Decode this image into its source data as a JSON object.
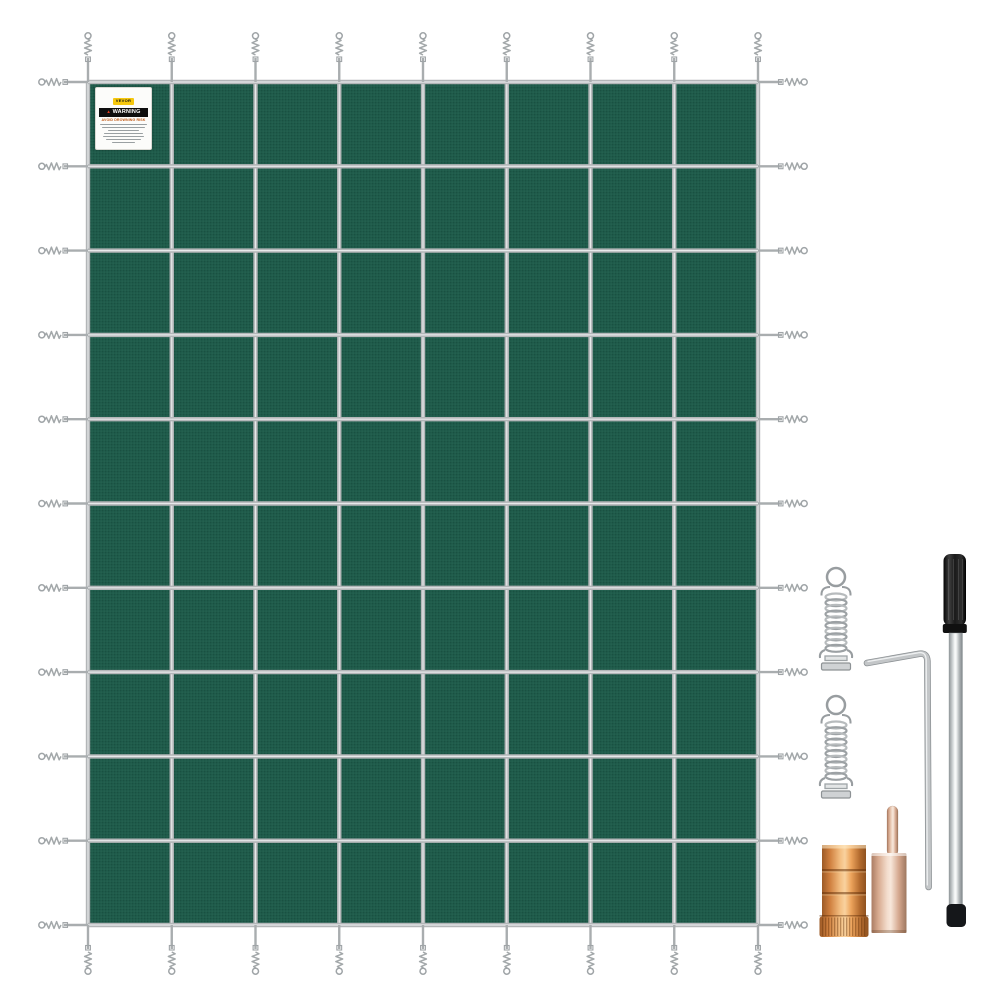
{
  "scene": {
    "background_color": "#ffffff",
    "items": [
      "pool-safety-cover",
      "anchor-spring",
      "anchor-spring",
      "hex-key",
      "brass-anchor",
      "brass-anchor-with-pin",
      "installation-rod"
    ]
  },
  "warning_label": {
    "brand": "VEVOR",
    "title": "WARNING",
    "heading": "AVOID DROWNING RISK",
    "body_lines": 7
  },
  "cover": {
    "grid_columns": 8,
    "grid_rows": 10,
    "mesh_color": "#1e5b4a",
    "mesh_shadow": "#153f34",
    "strap_color": "#b3b6b8",
    "strap_highlight": "#e7e9ea",
    "spring_color": "#9fa4a7"
  },
  "hardware_colors": {
    "silver": "#c3c6c8",
    "silver_dark": "#8d9295",
    "silver_light": "#eef0f1",
    "brass": "#e0914b",
    "rose": "#e9cab5",
    "black": "#141414"
  },
  "label_colors": {
    "badge_bg": "#f6c80e",
    "badge_text": "#111111",
    "bar_bg": "#0e0e0e",
    "bar_text": "#ffffff",
    "triangle": "#e23b1e",
    "heading": "#c05a17"
  }
}
